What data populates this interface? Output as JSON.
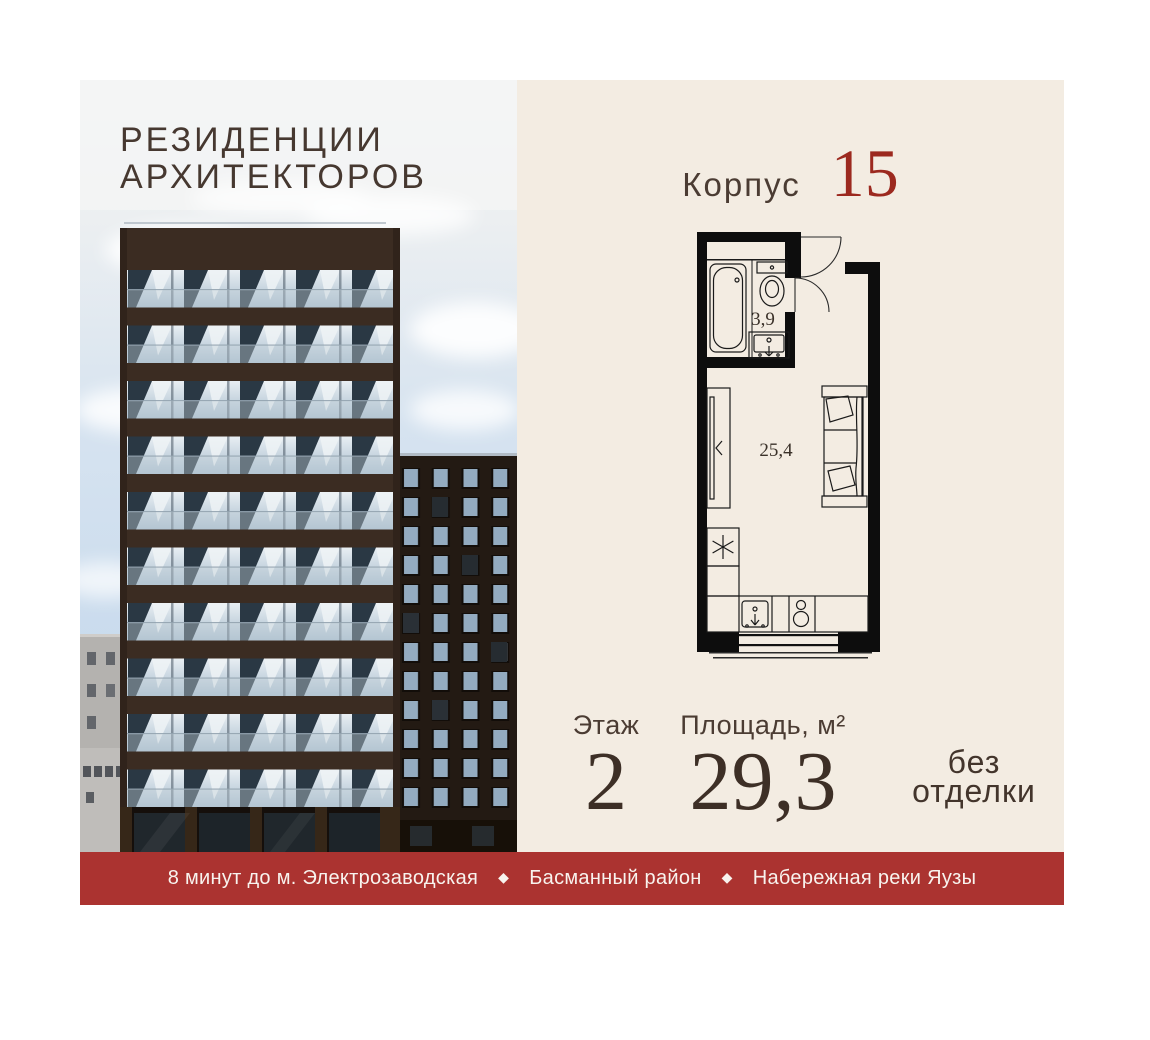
{
  "project": {
    "title_line1": "РЕЗИДЕНЦИИ",
    "title_line2": "АРХИТЕКТОРОВ"
  },
  "unit": {
    "building_label": "Корпус",
    "building_number": "15",
    "floor_label": "Этаж",
    "floor_value": "2",
    "area_label": "Площадь, м²",
    "area_value": "29,3",
    "finishing_line1": "без",
    "finishing_line2": "отделки"
  },
  "floor_plan": {
    "bathroom_area": "3,9",
    "room_area": "25,4"
  },
  "banner": {
    "separator": "◆",
    "items": [
      "8 минут до м. Электрозаводская",
      "Басманный район",
      "Набережная реки Яузы"
    ]
  },
  "colors": {
    "panel_cream": "#f3ece2",
    "banner_red": "#ab3330",
    "number_red": "#9c291f",
    "text_brown": "#46382f",
    "plan_wall_black": "#0d0d0d"
  }
}
